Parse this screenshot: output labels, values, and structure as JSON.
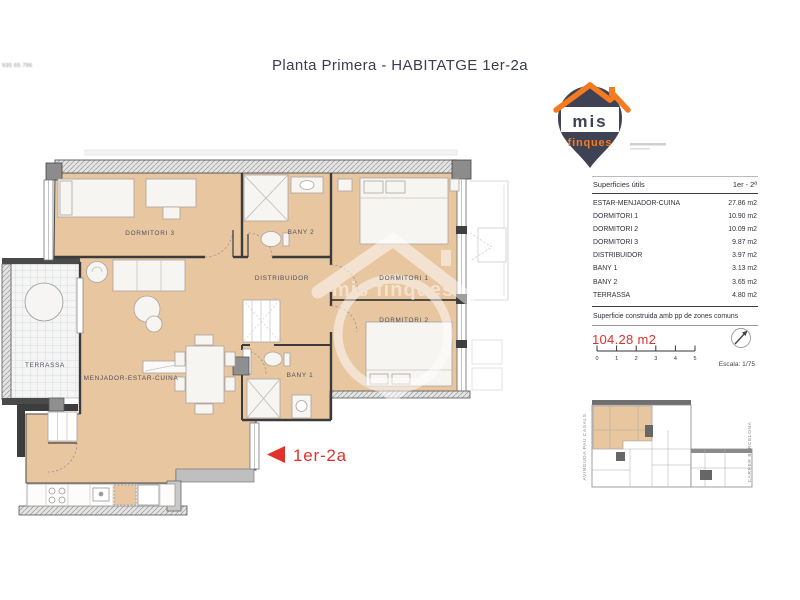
{
  "header": {
    "title": "Planta Primera - HABITATGE 1er-2a",
    "corner_text": "935 65 796"
  },
  "logo": {
    "brand_top": "mis",
    "brand_bottom": "finques"
  },
  "watermark": {
    "text": "mis finques"
  },
  "panel": {
    "table": {
      "header": {
        "label": "Superficies útils",
        "value": "1er - 2ª"
      },
      "rows": [
        {
          "label": "ESTAR-MENJADOR-CUINA",
          "value": "27.86 m2"
        },
        {
          "label": "DORMITORI 1",
          "value": "10.90 m2"
        },
        {
          "label": "DORMITORI 2",
          "value": "10.09 m2"
        },
        {
          "label": "DORMITORI 3",
          "value": "9.87 m2"
        },
        {
          "label": "DISTRIBUIDOR",
          "value": "3.97 m2"
        },
        {
          "label": "BANY 1",
          "value": "3.13 m2"
        },
        {
          "label": "BANY 2",
          "value": "3.65 m2"
        },
        {
          "label": "TERRASSA",
          "value": "4.80 m2"
        }
      ]
    },
    "construida_label": "Superficie construida amb pp de zones comuns",
    "construida_value": "104.28 m2",
    "scale": {
      "ticks": [
        "0",
        "1",
        "2",
        "3",
        "4",
        "5"
      ],
      "escala": "Escala: 1/75"
    }
  },
  "plan": {
    "marker": "1er-2a",
    "rooms": {
      "dormitori3": "DORMITORI 3",
      "bany2": "BANY 2",
      "distribuidor": "DISTRIBUIDOR",
      "dormitori1": "DORMITORI 1",
      "dormitori2": "DORMITORI 2",
      "menjador": "MENJADOR-ESTAR-CUINA",
      "terrassa": "TERRASSA",
      "bany1": "BANY 1"
    }
  },
  "siteplan": {
    "street_left": "AVINGUDA PAU CASALS",
    "street_right": "CARRER BARCELONA"
  },
  "colors": {
    "floor_tan": "#e8c6a0",
    "accent_red": "#e0312a",
    "logo_navy": "#3e4254",
    "logo_orange": "#f47b20"
  }
}
